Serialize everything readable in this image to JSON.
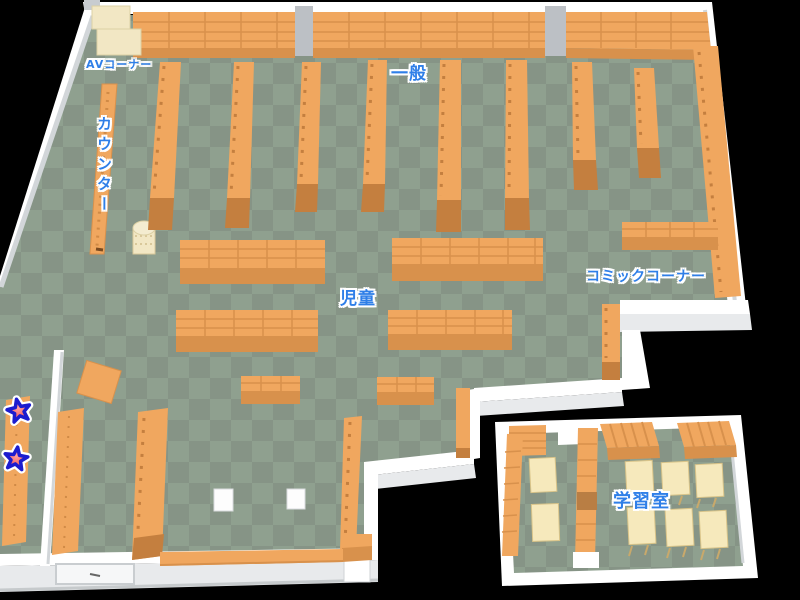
{
  "map_labels": {
    "av_corner": "AVコーナー",
    "counter": "カウンター",
    "general": "一般",
    "children": "児童",
    "comic_corner": "コミックコーナー",
    "study_room": "学習室"
  },
  "markers": {
    "stars_on_shelf": 2
  },
  "colors": {
    "floor_a": "#8fa08f",
    "floor_b": "#869486",
    "shelf": "#f0a75f",
    "shelf_side": "#d8914c",
    "shelf_base": "#c47f3f",
    "wall": "#ffffff",
    "wall_side": "#e8eaec",
    "wall_edge": "#c9cdd0",
    "cream": "#f2e7c4",
    "table": "#f6e9bc",
    "label": "#2f7fe8",
    "star": "#ee4444",
    "star_outline": "#1c1ccf",
    "window": "#bcc0c5"
  }
}
